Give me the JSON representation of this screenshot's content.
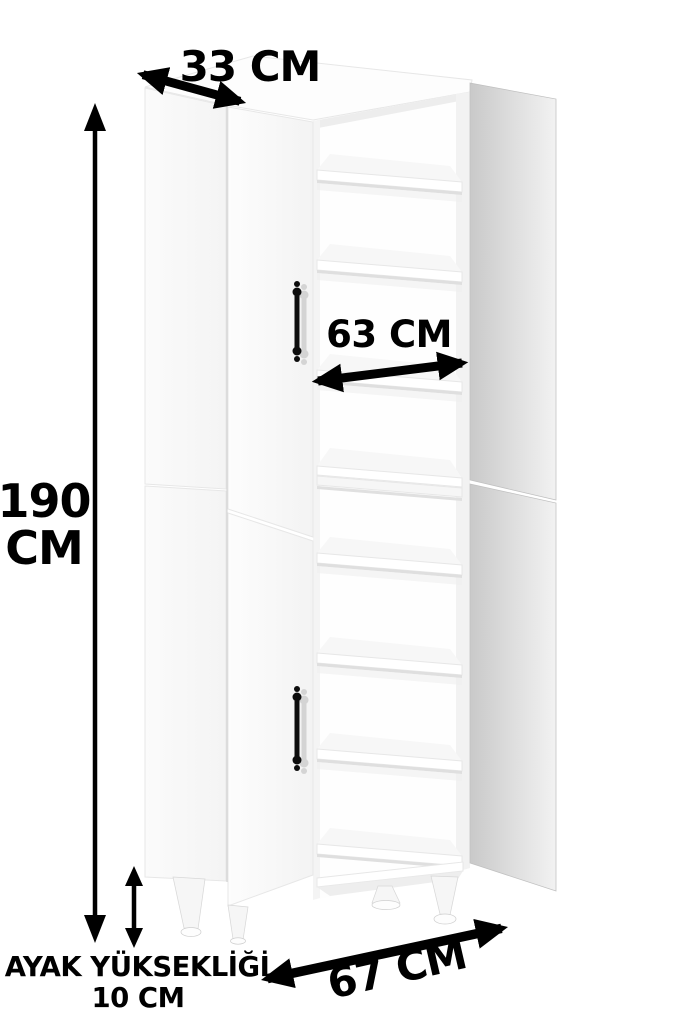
{
  "figure": {
    "type": "furniture-dimension-diagram",
    "subject": "tall white 4-door cabinet with open doors showing interior shelves, on legs"
  },
  "annotations": {
    "depth": {
      "label": "33 CM"
    },
    "height": {
      "value": "190",
      "unit": "CM"
    },
    "shelf_width": {
      "label": "63 CM"
    },
    "leg_height": {
      "title": "AYAK YÜKSEKLİĞİ",
      "value": "10 CM"
    },
    "width": {
      "label": "67 CM"
    }
  },
  "colors": {
    "background": "#ffffff",
    "ink": "#000000",
    "cabinet_white": "#fcfcfc",
    "panel_edge": "#e7e7e7",
    "shelf_shadow": "#dfdfdf",
    "open_door_gray_start": "#c9c9c9",
    "open_door_gray_end": "#f2f2f2",
    "handle_black": "#0d0d0d"
  }
}
